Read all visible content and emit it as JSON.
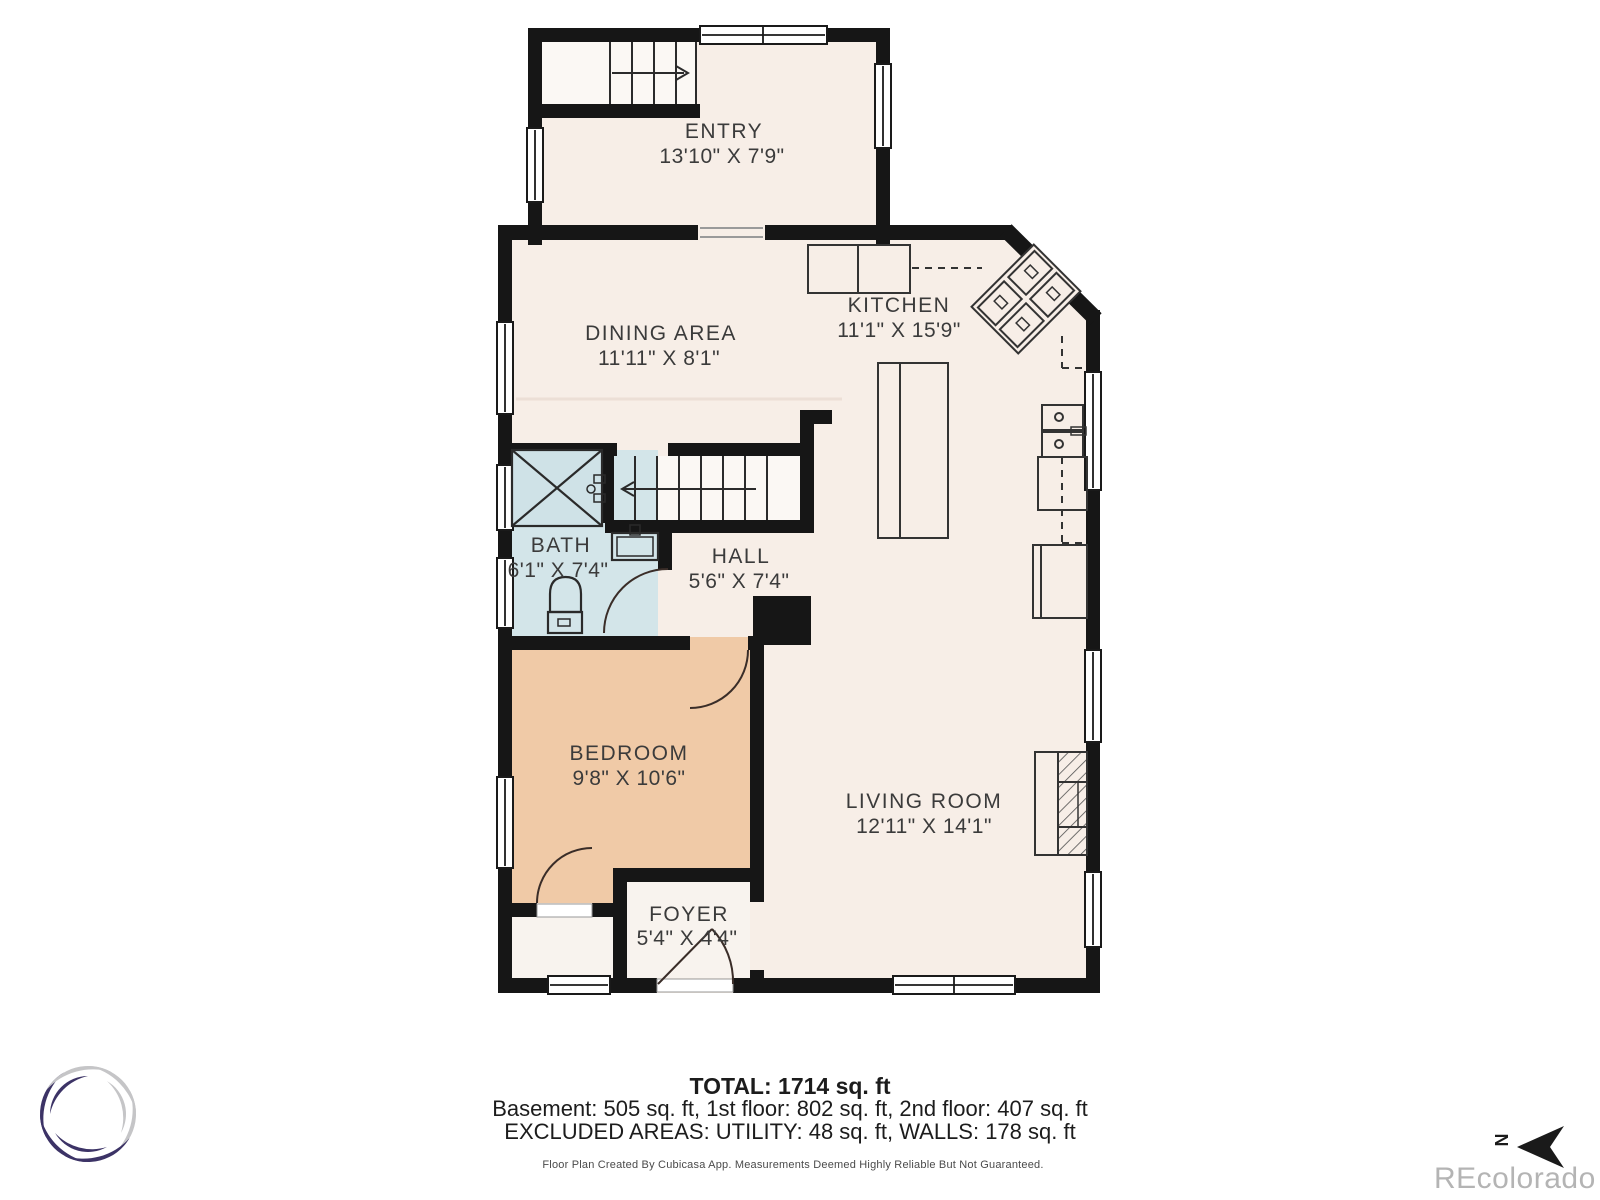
{
  "rooms": [
    {
      "name": "ENTRY",
      "dims": "13'10\" X 7'9\""
    },
    {
      "name": "DINING AREA",
      "dims": "11'11\" X 8'1\""
    },
    {
      "name": "KITCHEN",
      "dims": "11'1\" X 15'9\""
    },
    {
      "name": "BATH",
      "dims": "6'1\" X 7'4\""
    },
    {
      "name": "HALL",
      "dims": "5'6\" X 7'4\""
    },
    {
      "name": "BEDROOM",
      "dims": "9'8\" X 10'6\""
    },
    {
      "name": "LIVING ROOM",
      "dims": "12'11\" X 14'1\""
    },
    {
      "name": "FOYER",
      "dims": "5'4\" X 4'4\""
    }
  ],
  "summary": {
    "total": "TOTAL: 1714 sq. ft",
    "floors": "Basement: 505 sq. ft, 1st floor: 802 sq. ft, 2nd floor: 407 sq. ft",
    "excluded": "EXCLUDED AREAS: UTILITY: 48 sq. ft, WALLS: 178 sq. ft"
  },
  "footer": {
    "disclaimer": "Floor Plan Created By Cubicasa App. Measurements Deemed Highly Reliable But Not Guaranteed."
  },
  "watermark": "REcolorado",
  "compass": {
    "label": "N"
  },
  "colors": {
    "wall": "#161616",
    "floor": "#f7eee7",
    "bedroom": "#f0caa7",
    "bath": "#d3e5e9",
    "logo_navy": "#3c3366",
    "logo_silver": "#c5c5c7",
    "watermark_gray": "#b4b4b4"
  }
}
